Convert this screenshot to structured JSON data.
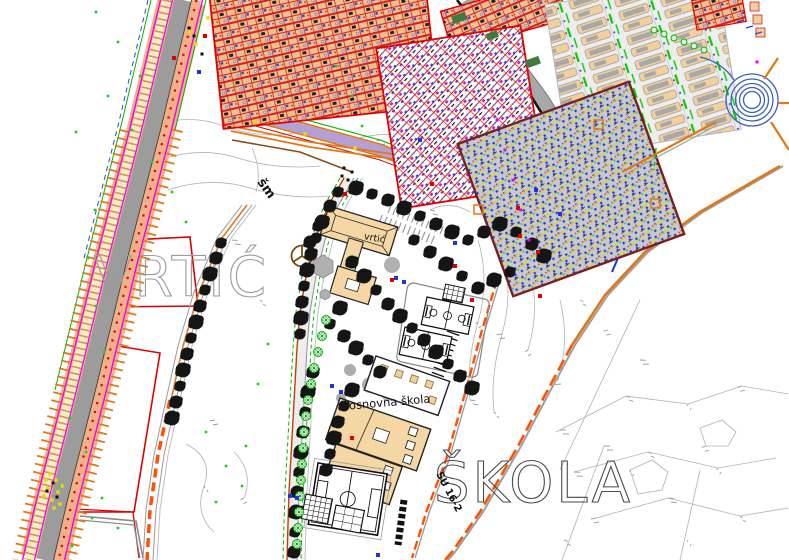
{
  "labels": {
    "kindergarten_small": "vrtić",
    "school_small": "osnovna škola",
    "kindergarten_large": "VRTIĆ",
    "school_large": "ŠKOLA",
    "road_label_1": "šm",
    "road_label_2": "SU 16-2"
  },
  "colors": {
    "orange": "#e07818",
    "bright_orange": "#ff5200",
    "salmon": "#f0b088",
    "road_gray": "#9c9c9c",
    "magenta": "#ee00ee",
    "red": "#e00000",
    "dark_red": "#7a1f1f",
    "tan": "#f5d7a6",
    "blue": "#2233dd",
    "green": "#00b400",
    "lavender": "#b4a0d4",
    "contour": "#b2b2b2",
    "label_gray": "#9a9a9a",
    "label_dark": "#4a4a4a",
    "yellow": "#f0d800"
  }
}
